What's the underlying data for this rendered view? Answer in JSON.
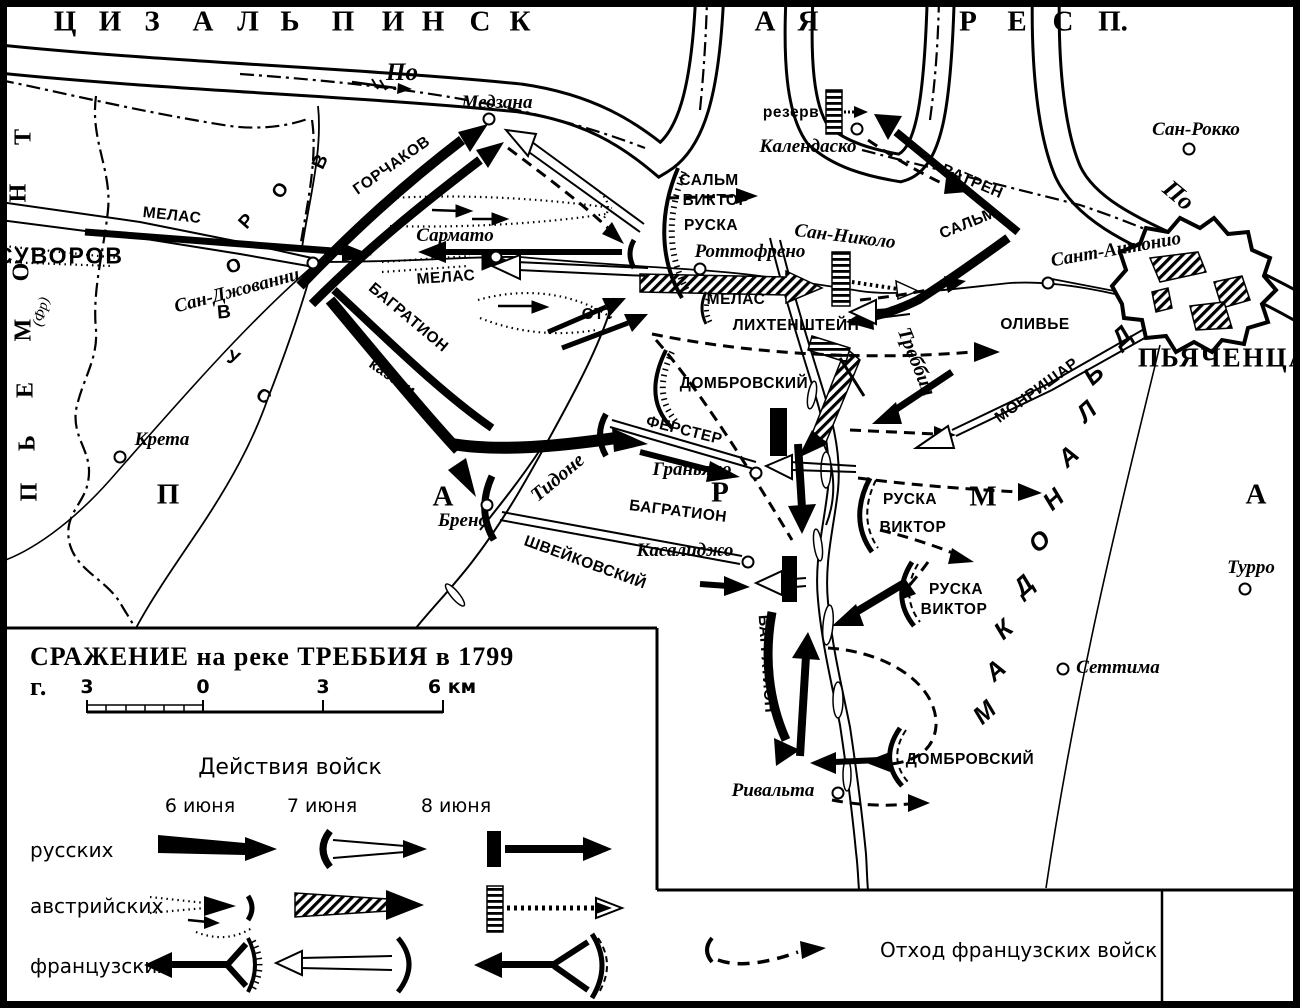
{
  "legend_box": {
    "title": "СРАЖЕНИЕ на реке ТРЕББИЯ в 1799 г.",
    "scale_ticks": [
      "3",
      "0",
      "3",
      "6 км"
    ],
    "actions_header": "Действия войск",
    "columns": [
      "6 июня",
      "7 июня",
      "8 июня"
    ],
    "rows": [
      "русских",
      "австрийских",
      "французских"
    ],
    "retreat_label": "Отход французских войск"
  },
  "map": {
    "labels": [
      {
        "name": "region-letter",
        "t": "Ц",
        "x": 65,
        "y": 22,
        "cls": "reg"
      },
      {
        "name": "region-letter",
        "t": "И",
        "x": 110,
        "y": 22,
        "cls": "reg"
      },
      {
        "name": "region-letter",
        "t": "З",
        "x": 152,
        "y": 22,
        "cls": "reg"
      },
      {
        "name": "region-letter",
        "t": "А",
        "x": 203,
        "y": 22,
        "cls": "reg"
      },
      {
        "name": "region-letter",
        "t": "Л",
        "x": 248,
        "y": 22,
        "cls": "reg"
      },
      {
        "name": "region-letter",
        "t": "Ь",
        "x": 290,
        "y": 22,
        "cls": "reg"
      },
      {
        "name": "region-letter",
        "t": "П",
        "x": 343,
        "y": 22,
        "cls": "reg"
      },
      {
        "name": "region-letter",
        "t": "И",
        "x": 393,
        "y": 22,
        "cls": "reg"
      },
      {
        "name": "region-letter",
        "t": "Н",
        "x": 433,
        "y": 22,
        "cls": "reg"
      },
      {
        "name": "region-letter",
        "t": "С",
        "x": 480,
        "y": 22,
        "cls": "reg"
      },
      {
        "name": "region-letter",
        "t": "К",
        "x": 520,
        "y": 22,
        "cls": "reg"
      },
      {
        "name": "region-letter",
        "t": "А",
        "x": 765,
        "y": 22,
        "cls": "reg"
      },
      {
        "name": "region-letter",
        "t": "Я",
        "x": 808,
        "y": 22,
        "cls": "reg"
      },
      {
        "name": "region-letter",
        "t": "Р",
        "x": 968,
        "y": 22,
        "cls": "reg"
      },
      {
        "name": "region-letter",
        "t": "Е",
        "x": 1017,
        "y": 22,
        "cls": "reg"
      },
      {
        "name": "region-letter",
        "t": "С",
        "x": 1063,
        "y": 22,
        "cls": "reg"
      },
      {
        "name": "region-letter",
        "t": "П.",
        "x": 1113,
        "y": 22,
        "cls": "reg"
      },
      {
        "name": "piedmont-letter",
        "t": "П",
        "x": 30,
        "y": 492,
        "cls": "regsm",
        "r": -90
      },
      {
        "name": "piedmont-letter",
        "t": "Ь",
        "x": 28,
        "y": 443,
        "cls": "regsm",
        "r": -90
      },
      {
        "name": "piedmont-letter",
        "t": "Е",
        "x": 26,
        "y": 390,
        "cls": "regsm",
        "r": -90
      },
      {
        "name": "piedmont-letter",
        "t": "М",
        "x": 24,
        "y": 330,
        "cls": "regsm",
        "r": -90
      },
      {
        "name": "piedmont-letter",
        "t": "О",
        "x": 22,
        "y": 272,
        "cls": "regsm",
        "r": -90
      },
      {
        "name": "piedmont-letter",
        "t": "Н",
        "x": 19,
        "y": 193,
        "cls": "regsm",
        "r": -90
      },
      {
        "name": "piedmont-letter",
        "t": "Т",
        "x": 24,
        "y": 137,
        "cls": "regsm",
        "r": -90
      },
      {
        "name": "piedmont-note",
        "t": "(Фр)",
        "x": 42,
        "y": 312,
        "cls": "note",
        "r": -75
      },
      {
        "name": "parma-letter",
        "t": "П",
        "x": 168,
        "y": 495,
        "cls": "reg"
      },
      {
        "name": "parma-letter",
        "t": "А",
        "x": 443,
        "y": 497,
        "cls": "reg"
      },
      {
        "name": "parma-letter",
        "t": "Р",
        "x": 720,
        "y": 493,
        "cls": "reg"
      },
      {
        "name": "parma-letter",
        "t": "М",
        "x": 983,
        "y": 497,
        "cls": "reg"
      },
      {
        "name": "parma-letter",
        "t": "А",
        "x": 1256,
        "y": 495,
        "cls": "reg"
      },
      {
        "name": "macdonald-letter",
        "t": "М",
        "x": 985,
        "y": 713,
        "cls": "mac",
        "r": -42
      },
      {
        "name": "macdonald-letter",
        "t": "А",
        "x": 996,
        "y": 671,
        "cls": "mac",
        "r": -42
      },
      {
        "name": "macdonald-letter",
        "t": "К",
        "x": 1004,
        "y": 630,
        "cls": "mac",
        "r": -42
      },
      {
        "name": "macdonald-letter",
        "t": "Д",
        "x": 1024,
        "y": 586,
        "cls": "mac",
        "r": -42
      },
      {
        "name": "macdonald-letter",
        "t": "О",
        "x": 1040,
        "y": 542,
        "cls": "mac",
        "r": -42
      },
      {
        "name": "macdonald-letter",
        "t": "Н",
        "x": 1054,
        "y": 500,
        "cls": "mac",
        "r": -42
      },
      {
        "name": "macdonald-letter",
        "t": "А",
        "x": 1069,
        "y": 457,
        "cls": "mac",
        "r": -42
      },
      {
        "name": "macdonald-letter",
        "t": "Л",
        "x": 1087,
        "y": 412,
        "cls": "mac",
        "r": -42
      },
      {
        "name": "macdonald-letter",
        "t": "Ь",
        "x": 1094,
        "y": 375,
        "cls": "mac",
        "r": -42
      },
      {
        "name": "macdonald-letter",
        "t": "Д",
        "x": 1122,
        "y": 337,
        "cls": "mac",
        "r": -42
      },
      {
        "name": "suvorov-curve-letter",
        "t": "В",
        "x": 321,
        "y": 162,
        "cls": "cur",
        "r": -65
      },
      {
        "name": "suvorov-curve-letter",
        "t": "О",
        "x": 281,
        "y": 191,
        "cls": "cur",
        "r": -55
      },
      {
        "name": "suvorov-curve-letter",
        "t": "Р",
        "x": 247,
        "y": 222,
        "cls": "cur",
        "r": -48
      },
      {
        "name": "suvorov-curve-letter",
        "t": "О",
        "x": 234,
        "y": 267,
        "cls": "cur",
        "r": -20
      },
      {
        "name": "suvorov-curve-letter",
        "t": "В",
        "x": 224,
        "y": 313,
        "cls": "cur",
        "r": -5
      },
      {
        "name": "suvorov-curve-letter",
        "t": "У",
        "x": 233,
        "y": 359,
        "cls": "cur",
        "r": 20
      },
      {
        "name": "suvorov-curve-letter",
        "t": "С",
        "x": 263,
        "y": 397,
        "cls": "cur",
        "r": 35
      },
      {
        "name": "river-label-po",
        "t": "По",
        "x": 402,
        "y": 73,
        "cls": "rivlg"
      },
      {
        "name": "river-label-po",
        "t": "По",
        "x": 1178,
        "y": 196,
        "cls": "rivlg",
        "r": 40
      },
      {
        "name": "river-label-trebbia",
        "t": "Треббия",
        "x": 916,
        "y": 362,
        "cls": "riv",
        "r": 68
      },
      {
        "name": "river-label-tidone",
        "t": "Тидоне",
        "x": 558,
        "y": 478,
        "cls": "riv",
        "r": -40
      },
      {
        "name": "town-label",
        "t": "Медзана",
        "x": 497,
        "y": 103,
        "cls": "twn"
      },
      {
        "name": "town-label",
        "t": "Сармато",
        "x": 455,
        "y": 236,
        "cls": "twn"
      },
      {
        "name": "town-label",
        "t": "Сан-Джованни",
        "x": 237,
        "y": 291,
        "cls": "twn",
        "r": -15
      },
      {
        "name": "town-label",
        "t": "Роттофрено",
        "x": 750,
        "y": 252,
        "cls": "twn"
      },
      {
        "name": "town-label",
        "t": "Сан-Николо",
        "x": 845,
        "y": 237,
        "cls": "twn",
        "r": 7
      },
      {
        "name": "town-label",
        "t": "Календаско",
        "x": 808,
        "y": 147,
        "cls": "twn"
      },
      {
        "name": "town-label",
        "t": "Сан-Рокко",
        "x": 1196,
        "y": 130,
        "cls": "twn"
      },
      {
        "name": "town-label",
        "t": "Сант-Антонио",
        "x": 1116,
        "y": 250,
        "cls": "twn",
        "r": -10
      },
      {
        "name": "town-label",
        "t": "Крета",
        "x": 162,
        "y": 440,
        "cls": "twn"
      },
      {
        "name": "town-label",
        "t": "Брено",
        "x": 463,
        "y": 521,
        "cls": "twn"
      },
      {
        "name": "town-label",
        "t": "Граньяно",
        "x": 692,
        "y": 470,
        "cls": "twn"
      },
      {
        "name": "town-label",
        "t": "Касалиджо",
        "x": 685,
        "y": 551,
        "cls": "twn"
      },
      {
        "name": "town-label",
        "t": "Ривальта",
        "x": 773,
        "y": 791,
        "cls": "twn"
      },
      {
        "name": "town-label",
        "t": "Сеттима",
        "x": 1118,
        "y": 668,
        "cls": "twn"
      },
      {
        "name": "town-label",
        "t": "Турро",
        "x": 1251,
        "y": 568,
        "cls": "twn"
      },
      {
        "name": "city-label",
        "t": "ПЬЯЧЕНЦА",
        "x": 1224,
        "y": 358,
        "cls": "city"
      },
      {
        "name": "force-label",
        "t": "СУВОРОВ",
        "x": 60,
        "y": 256,
        "cls": "cmdlg"
      },
      {
        "name": "force-label",
        "t": "МЕЛАС",
        "x": 172,
        "y": 216,
        "cls": "cmd",
        "r": 6
      },
      {
        "name": "force-label",
        "t": "ГОРЧАКОВ",
        "x": 392,
        "y": 166,
        "cls": "cmd",
        "r": -35
      },
      {
        "name": "force-label",
        "t": "БАГРАТИОН",
        "x": 408,
        "y": 318,
        "cls": "cmd",
        "r": 40
      },
      {
        "name": "force-label",
        "t": "казаки",
        "x": 392,
        "y": 378,
        "cls": "cmd",
        "r": 35
      },
      {
        "name": "force-label",
        "t": "МЕЛАС",
        "x": 446,
        "y": 278,
        "cls": "cmd",
        "r": -4
      },
      {
        "name": "force-label",
        "t": "ОТТ",
        "x": 598,
        "y": 315,
        "cls": "cmd"
      },
      {
        "name": "force-label",
        "t": "МЕЛАС",
        "x": 736,
        "y": 300,
        "cls": "cmd"
      },
      {
        "name": "force-label",
        "t": "ЛИХТЕНШТЕЙН",
        "x": 796,
        "y": 326,
        "cls": "cmd"
      },
      {
        "name": "force-label",
        "t": "САЛЬМ",
        "x": 709,
        "y": 181,
        "cls": "cmd"
      },
      {
        "name": "force-label",
        "t": "ВИКТОР",
        "x": 716,
        "y": 201,
        "cls": "cmd"
      },
      {
        "name": "force-label",
        "t": "РУСКА",
        "x": 711,
        "y": 226,
        "cls": "cmd"
      },
      {
        "name": "force-label",
        "t": "САЛЬМ",
        "x": 968,
        "y": 224,
        "cls": "cmd",
        "r": -22
      },
      {
        "name": "force-label",
        "t": "ВАТРЕН",
        "x": 972,
        "y": 182,
        "cls": "cmd",
        "r": 23
      },
      {
        "name": "force-label",
        "t": "резерв",
        "x": 791,
        "y": 113,
        "cls": "cmd"
      },
      {
        "name": "force-label",
        "t": "ОЛИВЬЕ",
        "x": 1035,
        "y": 325,
        "cls": "cmd"
      },
      {
        "name": "force-label",
        "t": "МОНРИШАР",
        "x": 1037,
        "y": 391,
        "cls": "cmd",
        "r": -36
      },
      {
        "name": "force-label",
        "t": "ДОМБРОВСКИЙ",
        "x": 744,
        "y": 384,
        "cls": "cmd"
      },
      {
        "name": "force-label",
        "t": "ФЕРСТЕР",
        "x": 684,
        "y": 431,
        "cls": "cmd",
        "r": 14
      },
      {
        "name": "force-label",
        "t": "БАГРАТИОН",
        "x": 678,
        "y": 512,
        "cls": "cmd",
        "r": 7
      },
      {
        "name": "force-label",
        "t": "ШВЕЙКОВСКИЙ",
        "x": 585,
        "y": 563,
        "cls": "cmd",
        "r": 20
      },
      {
        "name": "force-label",
        "t": "РУСКА",
        "x": 910,
        "y": 500,
        "cls": "cmd"
      },
      {
        "name": "force-label",
        "t": "ВИКТОР",
        "x": 913,
        "y": 528,
        "cls": "cmd"
      },
      {
        "name": "force-label",
        "t": "РУСКА",
        "x": 956,
        "y": 590,
        "cls": "cmd"
      },
      {
        "name": "force-label",
        "t": "ВИКТОР",
        "x": 954,
        "y": 610,
        "cls": "cmd"
      },
      {
        "name": "force-label",
        "t": "БАГРАТИОН",
        "x": 766,
        "y": 664,
        "cls": "cmd",
        "r": 86
      },
      {
        "name": "force-label",
        "t": "ДОМБРОВСКИЙ",
        "x": 970,
        "y": 760,
        "cls": "cmd"
      }
    ],
    "circles": [
      {
        "name": "town-circle",
        "x": 489,
        "y": 119
      },
      {
        "name": "town-circle",
        "x": 496,
        "y": 257
      },
      {
        "name": "town-circle",
        "x": 313,
        "y": 263
      },
      {
        "name": "town-circle",
        "x": 700,
        "y": 269
      },
      {
        "name": "town-circle",
        "x": 857,
        "y": 129
      },
      {
        "name": "town-circle",
        "x": 1189,
        "y": 149
      },
      {
        "name": "town-circle",
        "x": 1048,
        "y": 283
      },
      {
        "name": "town-circle",
        "x": 120,
        "y": 457
      },
      {
        "name": "town-circle",
        "x": 487,
        "y": 505
      },
      {
        "name": "town-circle",
        "x": 756,
        "y": 473
      },
      {
        "name": "town-circle",
        "x": 748,
        "y": 562
      },
      {
        "name": "town-circle",
        "x": 838,
        "y": 793
      },
      {
        "name": "town-circle",
        "x": 1063,
        "y": 669
      },
      {
        "name": "town-circle",
        "x": 1245,
        "y": 589
      }
    ]
  }
}
